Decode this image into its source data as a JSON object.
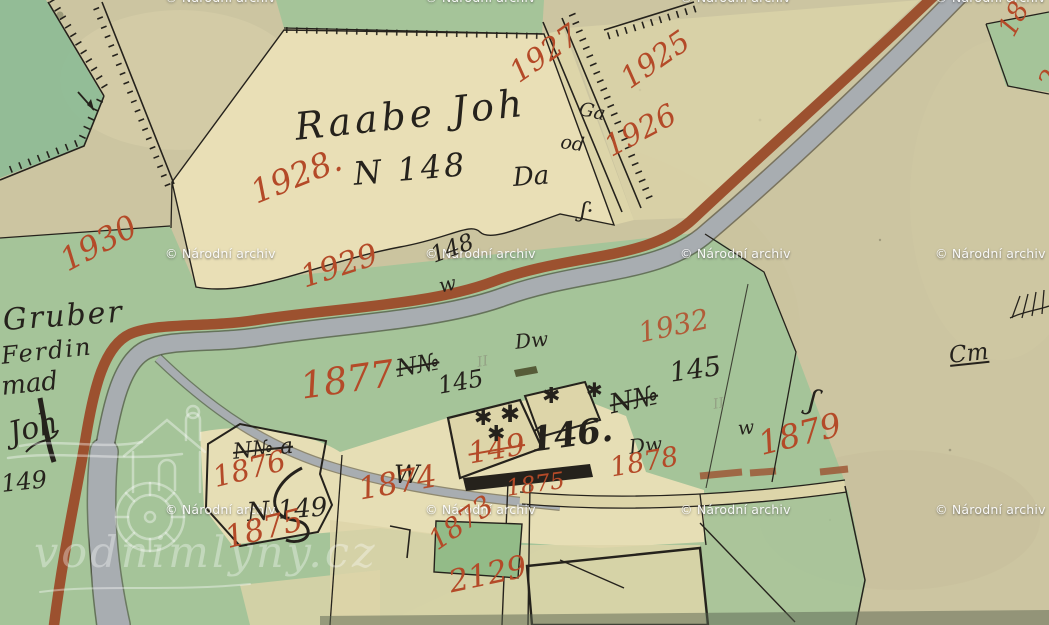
{
  "canvas": {
    "width": 1049,
    "height": 625
  },
  "palette": {
    "paper": "#ccc5a1",
    "paper2": "#d8d2ae",
    "cream": "#e9dfb6",
    "cream2": "#ddd5a9",
    "green": "#a5c499",
    "green2": "#93bb88",
    "teal": "#8fbc96",
    "road": "#9c512f",
    "stream": "#a8adb1",
    "ink": "#25221c",
    "red": "#b44a28",
    "faint": "#8a8f7a"
  },
  "watermark": {
    "text": "© Národní archiv",
    "instances": [
      {
        "x": 165,
        "y": -10
      },
      {
        "x": 425,
        "y": -10
      },
      {
        "x": 680,
        "y": -10
      },
      {
        "x": 935,
        "y": -10
      },
      {
        "x": 165,
        "y": 246
      },
      {
        "x": 425,
        "y": 246
      },
      {
        "x": 680,
        "y": 246
      },
      {
        "x": 935,
        "y": 246
      },
      {
        "x": 165,
        "y": 502
      },
      {
        "x": 425,
        "y": 502
      },
      {
        "x": 680,
        "y": 502
      },
      {
        "x": 935,
        "y": 502
      }
    ]
  },
  "logo": {
    "text": "vodnimlyny.cz",
    "icon": "watermill-house-gear"
  },
  "map": {
    "labels": [
      {
        "id": "raabe-joh",
        "text": "Raabe Joh",
        "x": 293,
        "y": 108,
        "size": 38,
        "color": "ink",
        "rot": -6,
        "ls": 4
      },
      {
        "id": "n-148",
        "text": "N 148",
        "x": 352,
        "y": 158,
        "size": 32,
        "color": "ink",
        "rot": -5,
        "ls": 3
      },
      {
        "id": "da",
        "text": "Da",
        "x": 512,
        "y": 165,
        "size": 26,
        "color": "ink",
        "rot": -4
      },
      {
        "id": "ga",
        "text": "Ga",
        "x": 581,
        "y": 100,
        "size": 19,
        "color": "ink",
        "rot": 12
      },
      {
        "id": "od",
        "text": "od",
        "x": 562,
        "y": 133,
        "size": 19,
        "color": "ink",
        "rot": 8
      },
      {
        "id": "num-148-small",
        "text": "148",
        "x": 428,
        "y": 246,
        "size": 23,
        "color": "ink",
        "rot": -20
      },
      {
        "id": "w-script-1",
        "text": "w",
        "x": 437,
        "y": 276,
        "size": 20,
        "color": "ink",
        "rot": -12
      },
      {
        "id": "gruber",
        "text": "Gruber",
        "x": 2,
        "y": 306,
        "size": 30,
        "color": "ink",
        "rot": -4,
        "ls": 2
      },
      {
        "id": "gruber-line2",
        "text": "Ferdin",
        "x": 0,
        "y": 344,
        "size": 24,
        "color": "ink",
        "rot": -6,
        "ls": 2
      },
      {
        "id": "gruber-line3",
        "text": "mad",
        "x": 0,
        "y": 374,
        "size": 26,
        "color": "ink",
        "rot": -6
      },
      {
        "id": "gruber-line4",
        "text": "Joh",
        "x": 6,
        "y": 420,
        "size": 30,
        "color": "ink",
        "rot": -14
      },
      {
        "id": "num-149-left",
        "text": "149",
        "x": 0,
        "y": 472,
        "size": 24,
        "color": "ink",
        "rot": -6
      },
      {
        "id": "n-no-center",
        "text": "N№",
        "x": 394,
        "y": 357,
        "size": 24,
        "color": "ink",
        "rot": -10,
        "strike": true
      },
      {
        "id": "num-145-center",
        "text": "145",
        "x": 436,
        "y": 374,
        "size": 24,
        "color": "ink",
        "rot": -10
      },
      {
        "id": "dw-1",
        "text": "Dw",
        "x": 514,
        "y": 332,
        "size": 20,
        "color": "ink",
        "rot": -6
      },
      {
        "id": "num-145-right",
        "text": "145",
        "x": 668,
        "y": 360,
        "size": 27,
        "color": "ink",
        "rot": -8
      },
      {
        "id": "n-no-right",
        "text": "N№",
        "x": 607,
        "y": 392,
        "size": 27,
        "color": "ink",
        "rot": -12,
        "strike": true
      },
      {
        "id": "w-script-2",
        "text": "w",
        "x": 737,
        "y": 420,
        "size": 19,
        "color": "ink",
        "rot": -6
      },
      {
        "id": "dw-2",
        "text": "Dw",
        "x": 628,
        "y": 437,
        "size": 20,
        "color": "ink",
        "rot": -6
      },
      {
        "id": "squiggle-f-1",
        "text": "ʃ",
        "x": 812,
        "y": 386,
        "size": 28,
        "color": "ink",
        "rot": 12
      },
      {
        "id": "squiggle-f-2",
        "text": "ʃ·",
        "x": 582,
        "y": 200,
        "size": 22,
        "color": "ink",
        "rot": 8
      },
      {
        "id": "n-no-a",
        "text": "N№ a",
        "x": 232,
        "y": 442,
        "size": 22,
        "color": "ink",
        "rot": -6,
        "strike": true
      },
      {
        "id": "n-149",
        "text": "N 149",
        "x": 246,
        "y": 500,
        "size": 26,
        "color": "ink",
        "rot": -4
      },
      {
        "id": "w-big",
        "text": "W",
        "x": 394,
        "y": 462,
        "size": 25,
        "color": "ink",
        "rot": 0,
        "ls": 1
      },
      {
        "id": "num-146",
        "text": "146.",
        "x": 528,
        "y": 424,
        "size": 34,
        "color": "ink",
        "rot": -8,
        "weight": 700
      },
      {
        "id": "cm-mark",
        "text": "Cm",
        "x": 948,
        "y": 345,
        "size": 23,
        "color": "ink",
        "rot": -6,
        "underline": true
      },
      {
        "id": "pencil-ii-1",
        "text": "II",
        "x": 476,
        "y": 356,
        "size": 14,
        "color": "faint",
        "rot": -10
      },
      {
        "id": "pencil-ii-2",
        "text": "II",
        "x": 712,
        "y": 398,
        "size": 14,
        "color": "faint",
        "rot": -10
      },
      {
        "id": "p1927",
        "text": "1927",
        "x": 505,
        "y": 64,
        "size": 30,
        "color": "red",
        "rot": -35
      },
      {
        "id": "p1925",
        "text": "1925",
        "x": 616,
        "y": 70,
        "size": 30,
        "color": "red",
        "rot": -35
      },
      {
        "id": "p1926",
        "text": "1926",
        "x": 600,
        "y": 136,
        "size": 30,
        "color": "red",
        "rot": -28
      },
      {
        "id": "p1928",
        "text": "1928.",
        "x": 246,
        "y": 178,
        "size": 33,
        "color": "red",
        "rot": -22
      },
      {
        "id": "p1930",
        "text": "1930",
        "x": 55,
        "y": 248,
        "size": 32,
        "color": "red",
        "rot": -28
      },
      {
        "id": "p1929",
        "text": "1929",
        "x": 297,
        "y": 264,
        "size": 31,
        "color": "red",
        "rot": -18
      },
      {
        "id": "p1932",
        "text": "1932",
        "x": 636,
        "y": 320,
        "size": 28,
        "color": "red",
        "rot": -12,
        "opacity": 0.85
      },
      {
        "id": "p1877",
        "text": "1877",
        "x": 298,
        "y": 368,
        "size": 37,
        "color": "red",
        "rot": -8
      },
      {
        "id": "p1876",
        "text": "1876",
        "x": 210,
        "y": 464,
        "size": 29,
        "color": "red",
        "rot": -14
      },
      {
        "id": "p1875a",
        "text": "1875",
        "x": 222,
        "y": 524,
        "size": 31,
        "color": "red",
        "rot": -14
      },
      {
        "id": "p1874",
        "text": "1874",
        "x": 356,
        "y": 475,
        "size": 31,
        "color": "red",
        "rot": -10
      },
      {
        "id": "p149-red",
        "text": "149",
        "x": 466,
        "y": 440,
        "size": 30,
        "color": "red",
        "rot": -10,
        "strike": true
      },
      {
        "id": "p1875b",
        "text": "1875",
        "x": 505,
        "y": 478,
        "size": 23,
        "color": "red",
        "rot": -8
      },
      {
        "id": "p1878",
        "text": "1878",
        "x": 608,
        "y": 455,
        "size": 27,
        "color": "red",
        "rot": -10
      },
      {
        "id": "p1879",
        "text": "1879",
        "x": 755,
        "y": 428,
        "size": 33,
        "color": "red",
        "rot": -14
      },
      {
        "id": "p1873",
        "text": "1873",
        "x": 424,
        "y": 532,
        "size": 28,
        "color": "red",
        "rot": -35
      },
      {
        "id": "p2129",
        "text": "2129",
        "x": 446,
        "y": 568,
        "size": 31,
        "color": "red",
        "rot": -12
      },
      {
        "id": "p18-ne",
        "text": "18",
        "x": 994,
        "y": 28,
        "size": 27,
        "color": "red",
        "rot": -62
      },
      {
        "id": "p2-ne",
        "text": "2",
        "x": 1034,
        "y": 80,
        "size": 27,
        "color": "red",
        "rot": -58
      }
    ],
    "symbols": [
      {
        "id": "tree-1",
        "glyph": "✱",
        "x": 474,
        "y": 408,
        "size": 22
      },
      {
        "id": "tree-2",
        "glyph": "✱",
        "x": 500,
        "y": 402,
        "size": 24
      },
      {
        "id": "tree-3",
        "glyph": "✱",
        "x": 487,
        "y": 424,
        "size": 22
      },
      {
        "id": "tree-4",
        "glyph": "✱",
        "x": 542,
        "y": 386,
        "size": 22
      },
      {
        "id": "tree-5",
        "glyph": "✱",
        "x": 586,
        "y": 380,
        "size": 20
      }
    ]
  }
}
